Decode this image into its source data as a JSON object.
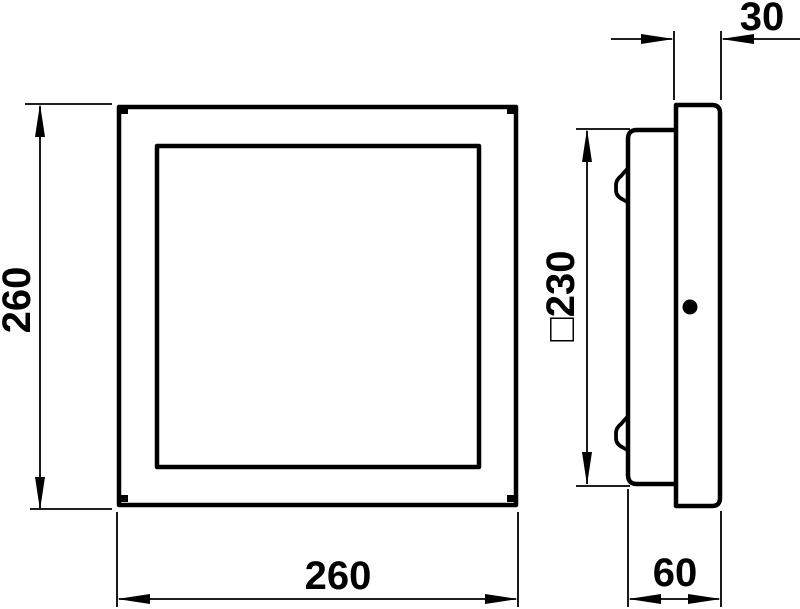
{
  "colors": {
    "line": "#000000",
    "background": "#ffffff"
  },
  "dimensions": {
    "front_height": {
      "label": "260"
    },
    "front_width": {
      "label": "260"
    },
    "bezel_depth": {
      "label": "30"
    },
    "recess_square": {
      "label": "□230"
    },
    "total_depth": {
      "label": "60"
    }
  }
}
